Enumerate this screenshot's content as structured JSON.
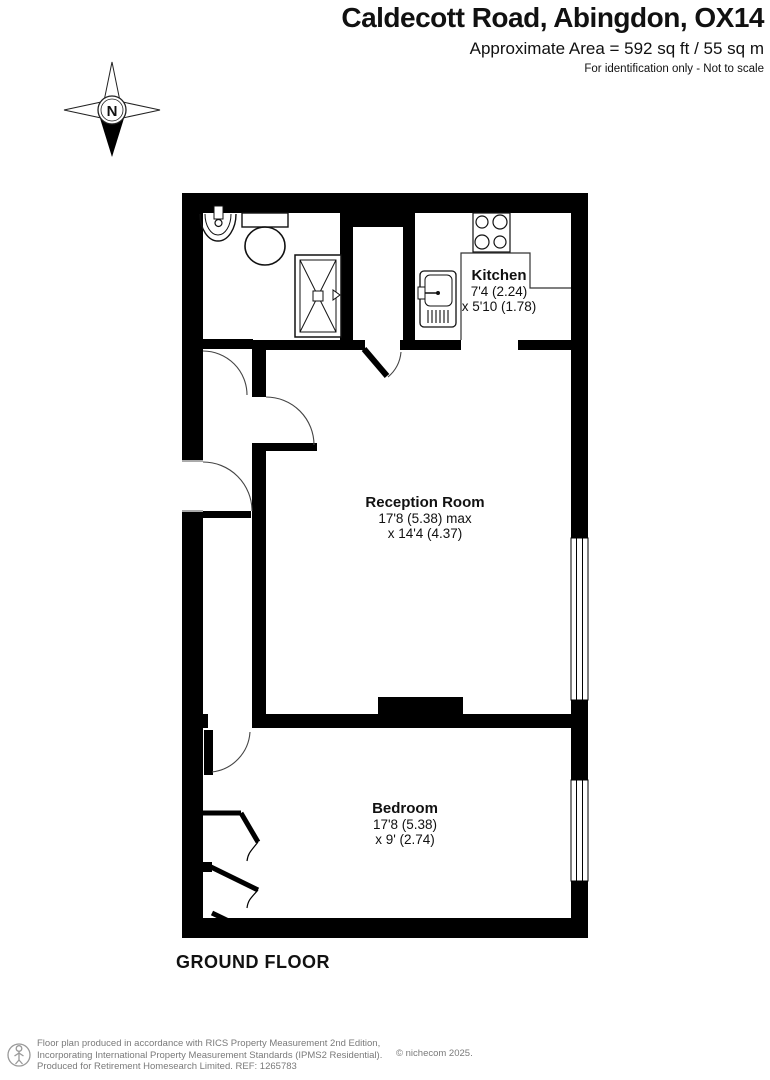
{
  "header": {
    "title": "Caldecott Road, Abingdon, OX14",
    "area": "Approximate Area = 592 sq ft / 55 sq m",
    "note": "For identification only - Not to scale"
  },
  "compass": {
    "label": "N"
  },
  "rooms": {
    "kitchen": {
      "name": "Kitchen",
      "dim1": "7'4 (2.24)",
      "dim2": "x 5'10 (1.78)"
    },
    "reception": {
      "name": "Reception Room",
      "dim1": "17'8 (5.38) max",
      "dim2": "x 14'4 (4.37)"
    },
    "bedroom": {
      "name": "Bedroom",
      "dim1": "17'8 (5.38)",
      "dim2": "x 9' (2.74)"
    }
  },
  "floor_label": "GROUND FLOOR",
  "footer": {
    "line1": "Floor plan produced in accordance with RICS Property Measurement 2nd Edition,",
    "line2": "Incorporating International Property Measurement Standards (IPMS2 Residential).",
    "line3": "Produced for Retirement Homesearch Limited.   REF: 1265783",
    "copyright": "© nichecom 2025."
  },
  "icons": [
    "compass-icon",
    "basin-icon",
    "toilet-icon",
    "shower-icon",
    "stove-icon",
    "sink-icon",
    "wardrobe-icon",
    "window",
    "door-arc",
    "person-logo-icon"
  ],
  "colors": {
    "wall": "#000000",
    "line": "#333333",
    "text": "#111111",
    "footer_text": "#7a7a7a"
  }
}
